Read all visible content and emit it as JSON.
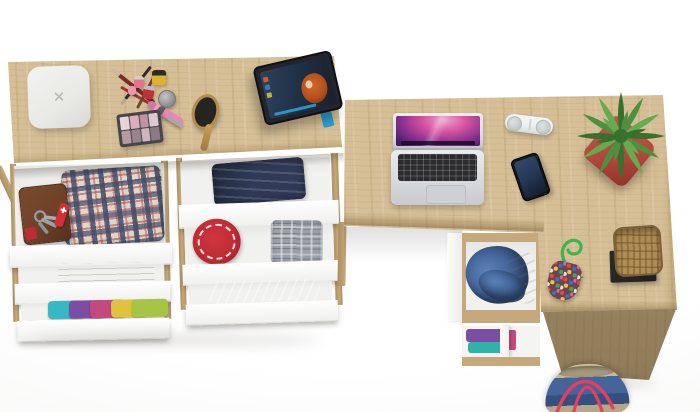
{
  "meta": {
    "alt": "Top view 3D render of an oak dressing table with six open white drawers full of clothes and accessories, connected to an L-shaped oak desk with a laptop, portable speaker, smartphone, potted plant, wicker basket, beaded pouch and a denim duffel bag"
  },
  "palette": {
    "wood": "#d6bf96",
    "wood_dark": "#c5a97c",
    "wood_deep": "#ad8f5e",
    "front_white": "#fbfbfa",
    "interior": "#f1f1ef",
    "laptop_silver": "#dcdde0",
    "laptop_keys": "#2c2c2f",
    "trackpad": "#cfd0d3",
    "screen_dark": "#241243",
    "speaker": "#eef0f0",
    "grille": "#c2c8c8",
    "phone": "#15171b",
    "phone_screen": "#26395a",
    "pot": "#b24a3c",
    "leaf_dark": "#38702e",
    "leaf_mid": "#4f9040",
    "leaf_light": "#66ab50",
    "tablet_frame": "#22262c",
    "tablet_screen": "#22344b",
    "hair": "#b44f1d",
    "stand_blue": "#2f9fd0",
    "charger": "#e9e9e6",
    "charger_x": "#b5b5b2",
    "wallet": "#6e4128",
    "knife": "#d42f35",
    "metal": "#9aa1a8",
    "plaid_base": "#dfd8c6",
    "plaid_blue": "#46516c",
    "plaid_red": "#b4454e",
    "jeans": "#2e3a57",
    "hat_red": "#bf2b34",
    "gray_garment": "#9aa0a8",
    "gray_light": "#d7dade",
    "towel": "#e6e6e3",
    "denim": "#46679c",
    "denim_dark": "#35507c",
    "cream": "#e3e7dc",
    "basket": "#b08d52",
    "basket_dark": "#7d6136",
    "stand_black": "#202021",
    "bag_blue": "#45659a",
    "bag_tan": "#c9ba97",
    "strap": "#e83e5e",
    "cord": "#3cb649",
    "pouch": "#6d4550"
  },
  "objects": {
    "vanity": {
      "label": "Oak dressing table with six open white drawers"
    },
    "desk": {
      "label": "Oak L-shaped desk with pedestal drawers"
    },
    "charger": {
      "label": "White charging box with x logo",
      "glyph": "✕"
    },
    "makeup_brushes": {
      "label": "Makeup brushes"
    },
    "nail_polish": {
      "label": "Nail polish bottles"
    },
    "cream_jar": {
      "label": "Cosmetic jar"
    },
    "lip_gloss": {
      "label": "Pink lip gloss tubes"
    },
    "eyeshadow": {
      "label": "Eyeshadow palette",
      "swatches": [
        {
          "style": "background:#e8d3da"
        },
        {
          "style": "background:#d9aebb"
        },
        {
          "style": "background:#c291a2"
        },
        {
          "style": "background:#ddcad0"
        },
        {
          "style": "background:#b39aa4"
        },
        {
          "style": "background:#96838c"
        },
        {
          "style": "background:#cdb6bd"
        },
        {
          "style": "background:#8d7b83"
        }
      ]
    },
    "hairbrush": {
      "label": "Wooden hairbrush"
    },
    "tablet": {
      "label": "Tablet on blue stand playing a movie with a red-haired character"
    },
    "wallet": {
      "label": "Brown leather wallet"
    },
    "keys": {
      "label": "Key ring with keys"
    },
    "knife": {
      "label": "Red pocket knife"
    },
    "plaid_shirt": {
      "label": "Folded red and blue plaid shirts"
    },
    "towel": {
      "label": "Folded white towel"
    },
    "clothes_stack": {
      "label": "Stack of colorful folded clothes",
      "items": [
        {
          "style": "background:#37b9c3"
        },
        {
          "style": "background:#7b4ea3"
        },
        {
          "style": "background:#c4497f"
        },
        {
          "style": "background:#dfc23e"
        },
        {
          "style": "background:#a6c544"
        }
      ]
    },
    "jeans": {
      "label": "Folded dark jeans"
    },
    "red_hat": {
      "label": "Red patterned sun hat"
    },
    "gray_shirt": {
      "label": "Folded gray plaid shirt"
    },
    "striped_shirt": {
      "label": "Folded gray striped shirt"
    },
    "laptop": {
      "label": "Open silver laptop with purple aurora wallpaper"
    },
    "speaker": {
      "label": "White capsule portable speaker"
    },
    "phone": {
      "label": "Black smartphone"
    },
    "plant": {
      "label": "Green succulent plant in red square planter"
    },
    "pouch": {
      "label": "Multicolor beaded pouch with green cord"
    },
    "basket": {
      "label": "Wicker basket on black stand"
    },
    "desk_drawer": {
      "label": "Open desk drawer with denim and cream clothes"
    },
    "shelf": {
      "label": "Open shelf with folded purple and teal clothes",
      "items": [
        {
          "style": "background:#7b4ea3"
        },
        {
          "style": "background:#2fb3a8"
        },
        {
          "style": "background:#c4497f"
        }
      ]
    },
    "duffel": {
      "label": "Denim duffel bag with red straps"
    }
  }
}
